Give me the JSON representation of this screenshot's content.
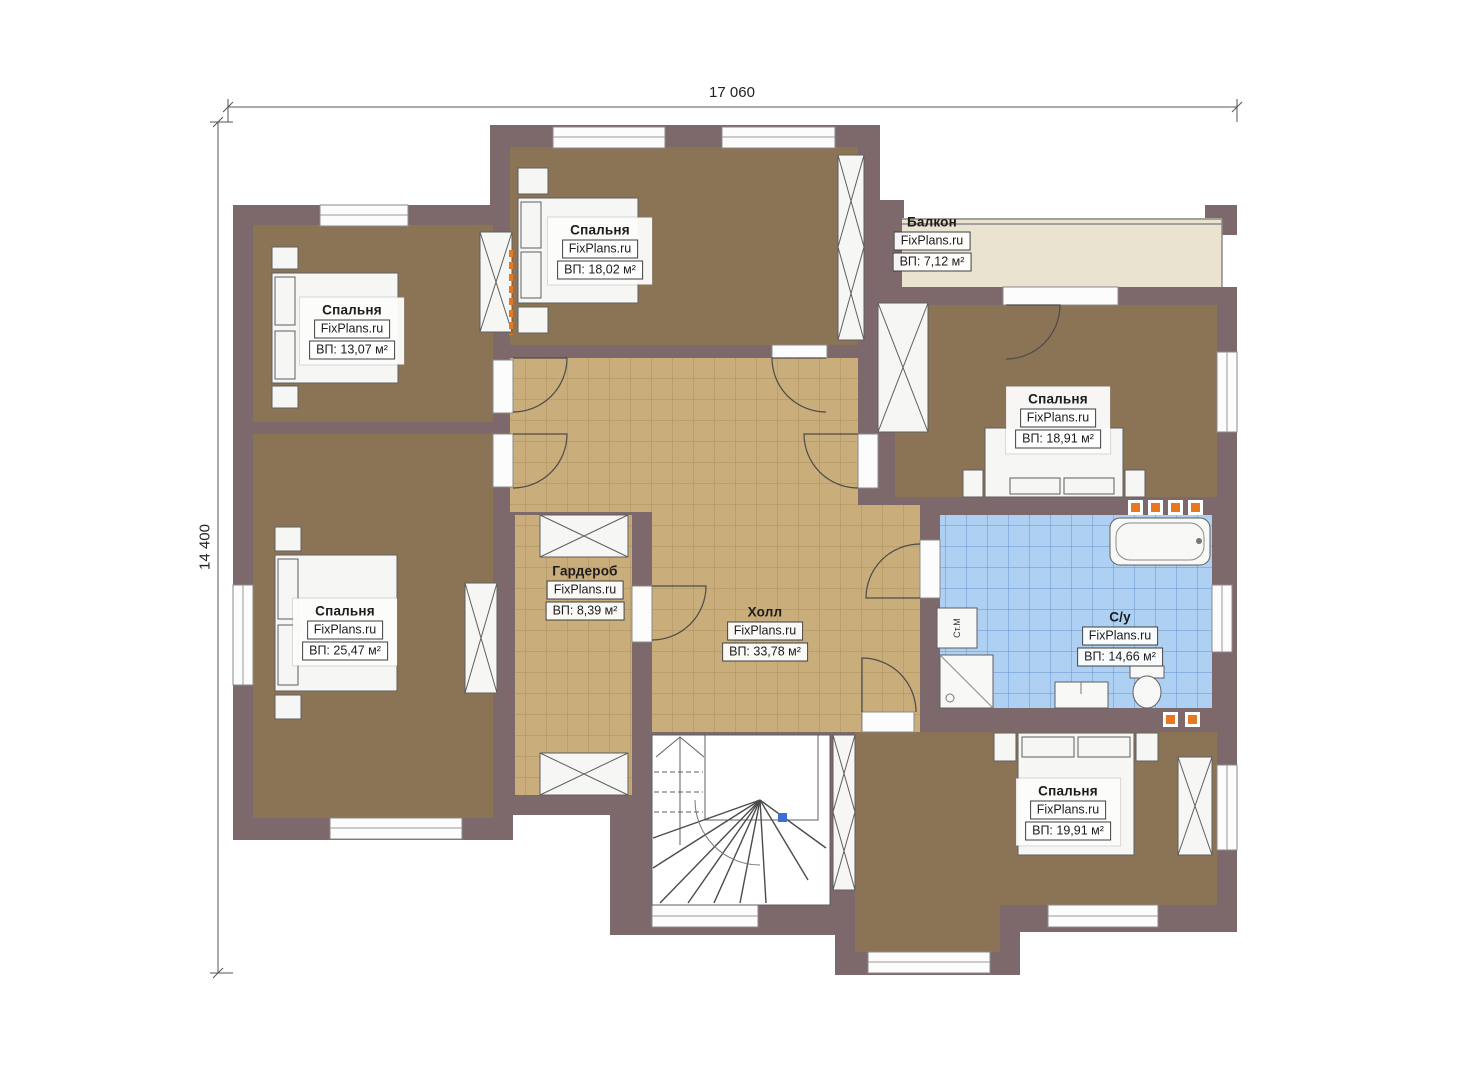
{
  "plan": {
    "dimensions": {
      "width_label": "17 060",
      "height_label": "14 400"
    },
    "rooms": [
      {
        "id": "bedroom-top-left",
        "name": "Спальня",
        "brand": "FixPlans.ru",
        "area": "ВП: 13,07 м²"
      },
      {
        "id": "bedroom-top-middle",
        "name": "Спальня",
        "brand": "FixPlans.ru",
        "area": "ВП: 18,02 м²"
      },
      {
        "id": "balcony",
        "name": "Балкон",
        "brand": "FixPlans.ru",
        "area": "ВП: 7,12 м²"
      },
      {
        "id": "bedroom-right",
        "name": "Спальня",
        "brand": "FixPlans.ru",
        "area": "ВП: 18,91 м²"
      },
      {
        "id": "bedroom-left",
        "name": "Спальня",
        "brand": "FixPlans.ru",
        "area": "ВП: 25,47 м²"
      },
      {
        "id": "wardrobe",
        "name": "Гардероб",
        "brand": "FixPlans.ru",
        "area": "ВП: 8,39 м²"
      },
      {
        "id": "hall",
        "name": "Холл",
        "brand": "FixPlans.ru",
        "area": "ВП: 33,78 м²"
      },
      {
        "id": "bathroom",
        "name": "С/у",
        "brand": "FixPlans.ru",
        "area": "ВП: 14,66 м²"
      },
      {
        "id": "bedroom-bottom-right",
        "name": "Спальня",
        "brand": "FixPlans.ru",
        "area": "ВП: 19,91 м²"
      }
    ],
    "fixtures": {
      "washing_machine": "Ст.М"
    },
    "colors": {
      "wall": "#7d696c",
      "bedroom_floor": "#8b7456",
      "hall_floor": "#c9ad7a",
      "bath_floor": "#aed0f2",
      "balcony_floor": "#eae3d0",
      "accent_orange": "#e87722"
    }
  }
}
